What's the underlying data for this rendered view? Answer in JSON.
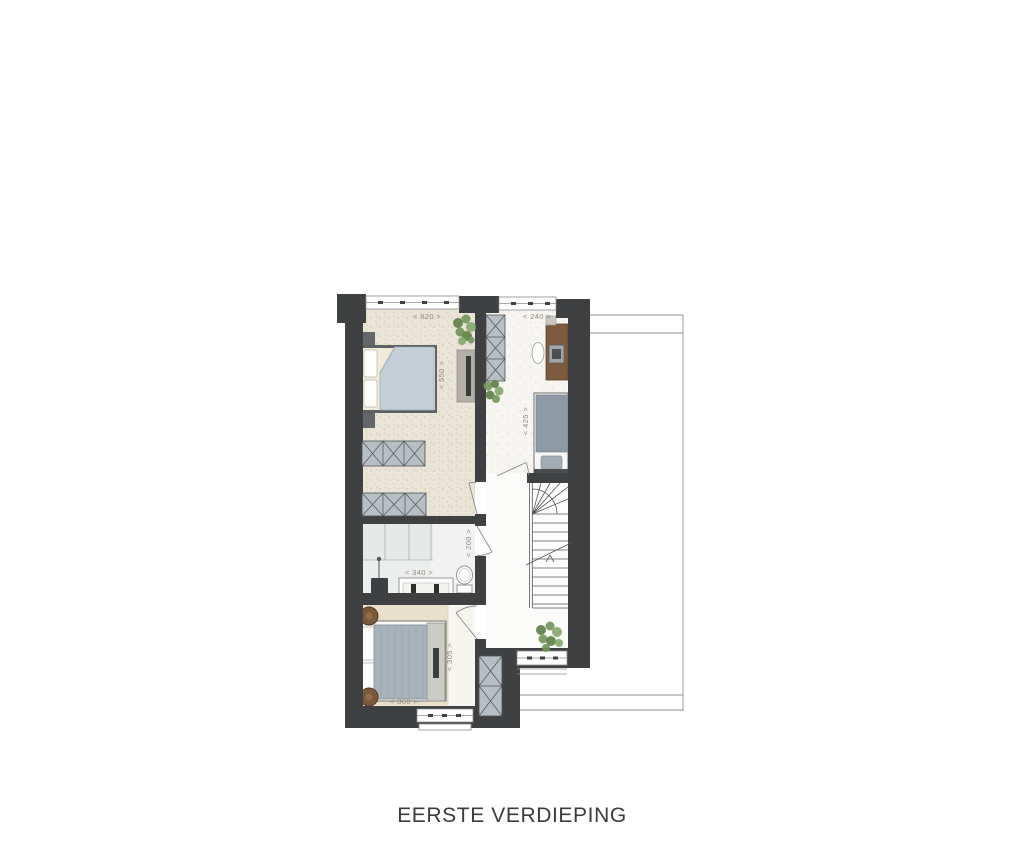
{
  "title": "EERSTE VERDIEPING",
  "floorplan": {
    "name": "eerste-verdieping-plattegrond",
    "rooms": {
      "bedroom_main": {
        "label_width": "< 820 >",
        "label_depth": "< 550 >"
      },
      "bedroom_study": {
        "label_width": "< 240 >",
        "label_depth": "< 425 >"
      },
      "bathroom": {
        "label_width": "< 340 >",
        "label_depth": "< 200 >"
      },
      "bedroom_back": {
        "label_width": "< 360 >",
        "label_depth": "< 305 >"
      }
    },
    "colors": {
      "wall": "#3f4042",
      "floor_beige": "#e9e4d6",
      "floor_light": "#f6f5f1",
      "rug": "#e9e0cb",
      "closet": "#b7bec4",
      "duvet_light": "#c5cfd8",
      "duvet_grey": "#8e9ba6",
      "wood_desk": "#7d5b3c",
      "wood_table": "#7b5a3b",
      "plant_green": "#6f9455",
      "dimension_text": "#8f8b7d",
      "title_text": "#3b3b3b"
    }
  }
}
